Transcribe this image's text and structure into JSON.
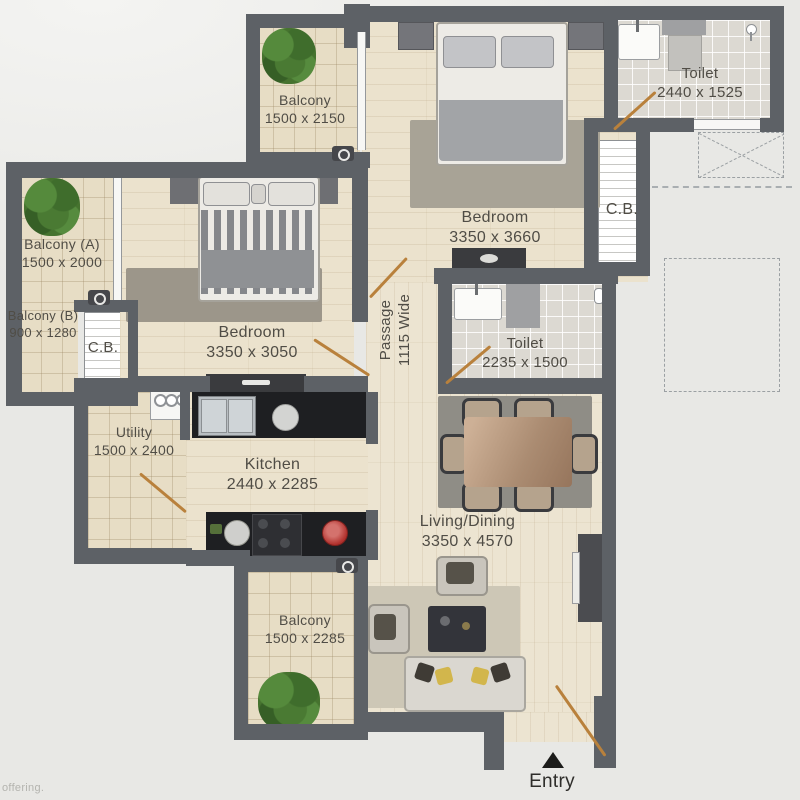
{
  "plan": {
    "rooms": {
      "balcony_top": {
        "name": "Balcony",
        "dims": "1500 x 2150"
      },
      "bedroom_top": {
        "name": "Bedroom",
        "dims": "3350 x 3660"
      },
      "toilet_top": {
        "name": "Toilet",
        "dims": "2440 x 1525"
      },
      "cb_right": {
        "name": "C.B."
      },
      "balcony_a": {
        "name": "Balcony (A)",
        "dims": "1500 x 2000"
      },
      "balcony_b": {
        "name": "Balcony (B)",
        "dims": "900 x 1280"
      },
      "cb_left": {
        "name": "C.B."
      },
      "bedroom_left": {
        "name": "Bedroom",
        "dims": "3350 x 3050"
      },
      "passage": {
        "name": "Passage",
        "dims": "1115 Wide"
      },
      "toilet_mid": {
        "name": "Toilet",
        "dims": "2235 x 1500"
      },
      "utility": {
        "name": "Utility",
        "dims": "1500 x 2400"
      },
      "kitchen": {
        "name": "Kitchen",
        "dims": "2440 x 2285"
      },
      "living_dining": {
        "name": "Living/Dining",
        "dims": "3350 x 4570"
      },
      "balcony_bottom": {
        "name": "Balcony",
        "dims": "1500 x 2285"
      }
    },
    "entry_label": "Entry",
    "watermark": "offering."
  },
  "colors": {
    "wall": "#5d6166",
    "floor_wood": "#ebe2cd",
    "floor_tile": "#e7ddc5",
    "floor_bath": "#dcd9d2",
    "door_swing": "#b9813c",
    "plant_green": "#46732f",
    "accent_red": "#b0302c",
    "accent_yellow": "#d2b64c",
    "label_text": "#504d46"
  }
}
